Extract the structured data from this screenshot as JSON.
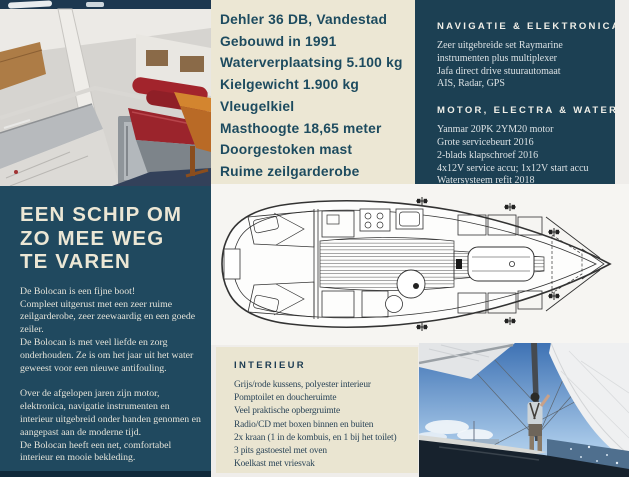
{
  "colors": {
    "cream_panel": "#ece7d4",
    "navy_panel": "#1c4053",
    "story_panel": "#20495f",
    "bottom_strip": "#10293a",
    "spec_text": "#1d4b5f",
    "heading_text": "#ece7d5",
    "body_light_text": "#dbe1e4",
    "interior_heading": "#1d3c52",
    "interior_text": "#2b4558",
    "cushion_red": "#9b242c",
    "sky_blue": "#3e72b4"
  },
  "images": {
    "cabin": "cabin-interior-photo",
    "deck_plan": "deck-plan-drawing",
    "sailing": "sailing-photo"
  },
  "specs": {
    "lines": [
      "Dehler 36 DB, Vandestad",
      "Gebouwd in 1991",
      "Waterverplaatsing 5.100 kg",
      "Kielgewicht 1.900 kg",
      "Vleugelkiel",
      "Masthoogte 18,65 meter",
      "Doorgestoken mast",
      "Ruime zeilgarderobe"
    ]
  },
  "navigation_panel": {
    "title": "NAVIGATIE & ELEKTRONICA",
    "lines": [
      "Zeer uitgebreide set Raymarine",
      "instrumenten plus multiplexer",
      "Jafa direct drive stuurautomaat",
      "AIS, Radar, GPS"
    ]
  },
  "motor_panel": {
    "title": "MOTOR, ELECTRA & WATER",
    "lines": [
      "Yanmar 20PK 2YM20 motor",
      "Grote servicebeurt 2016",
      "2-blads klapschroef 2016",
      "4x12V service accu; 1x12V start accu",
      "Watersysteem refit 2018"
    ]
  },
  "story_panel": {
    "title_lines": [
      "EEN SCHIP OM",
      "ZO MEE WEG",
      "TE VAREN"
    ],
    "blocks": [
      [
        "De Bolocan is een fijne boot!",
        "Compleet uitgerust met een zeer ruime zeilgarderobe, zeer zeewaardig en een goede zeiler.",
        "De Bolocan is met veel liefde en zorg onderhouden. Ze is om het jaar uit het water geweest voor een nieuwe antifouling."
      ],
      [
        "Over de afgelopen jaren zijn motor, elektronica, navigatie instrumenten en interieur uitgebreid onder handen genomen en aangepast aan de moderne tijd.",
        "De Bolocan heeft een net, comfortabel interieur en mooie bekleding."
      ],
      [
        "Kortom: een schip om zó mee weg te varen!"
      ]
    ]
  },
  "interior_panel": {
    "title": "INTERIEUR",
    "lines": [
      "Grijs/rode kussens, polyester interieur",
      "Pomptoilet en doucheruimte",
      "Veel praktische opbergruimte",
      "Radio/CD met boxen binnen en buiten",
      "2x kraan (1 in de kombuis, en 1 bij het toilet)",
      "3 pits gastoestel met oven",
      "Koelkast met vriesvak"
    ]
  }
}
